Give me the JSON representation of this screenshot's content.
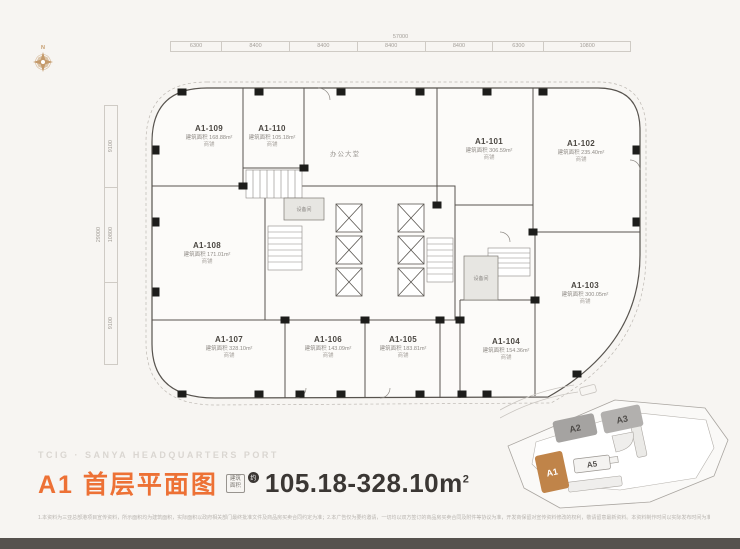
{
  "colors": {
    "accent_orange": "#ED7135",
    "building_highlight": "#C08449",
    "building_gray": "#ABA9A7",
    "dark_text": "#3B3734",
    "plan_line": "#57534E"
  },
  "compass": {
    "north_label": "N"
  },
  "dimensions": {
    "top": {
      "total": "57000",
      "segments": [
        "6300",
        "8400",
        "8400",
        "8400",
        "8400",
        "6300",
        "10800"
      ]
    },
    "left": {
      "total": "29000",
      "segments": [
        "9100",
        "10800",
        "9100"
      ]
    }
  },
  "plan": {
    "lobby_label": "办公大堂",
    "area_prefix": "建筑面积",
    "unit_type": "商铺",
    "room_label_a": "设备间",
    "room_label_b": "设备间",
    "units": [
      {
        "id": "A1-109",
        "area": "168.88m²"
      },
      {
        "id": "A1-110",
        "area": "105.18m²"
      },
      {
        "id": "A1-101",
        "area": "306.59m²"
      },
      {
        "id": "A1-102",
        "area": "235.40m²"
      },
      {
        "id": "A1-103",
        "area": "300.05m²"
      },
      {
        "id": "A1-104",
        "area": "154.36m²"
      },
      {
        "id": "A1-105",
        "area": "183.81m²"
      },
      {
        "id": "A1-106",
        "area": "143.09m²"
      },
      {
        "id": "A1-107",
        "area": "328.10m²"
      },
      {
        "id": "A1-108",
        "area": "171.01m²"
      }
    ]
  },
  "siteplan": {
    "buildings": [
      {
        "label": "A2"
      },
      {
        "label": "A3"
      },
      {
        "label": "A1"
      },
      {
        "label": "A5"
      }
    ]
  },
  "footer": {
    "brand": "TCIG · SANYA HEADQUARTERS PORT",
    "title": "A1 首层平面图",
    "area_box_top": "建筑",
    "area_box_bottom": "面积",
    "approx_badge": "约",
    "area_range": "105.18-328.10m",
    "area_range_sup": "2",
    "disclaimer": "1.本资料为三亚总部港项目宣传资料，所示面积均为建筑面积，实际面积以政府相关部门最终批准文件及商品房买卖合同约定为准；2.本广告仅为要约邀请，一切均以双方签订的商品房买卖合同及附件等协议为准，开发商保留对宣传资料修改的权利，敬请留意最新资料。本资料制作时间以实际发布时间为准。"
  }
}
